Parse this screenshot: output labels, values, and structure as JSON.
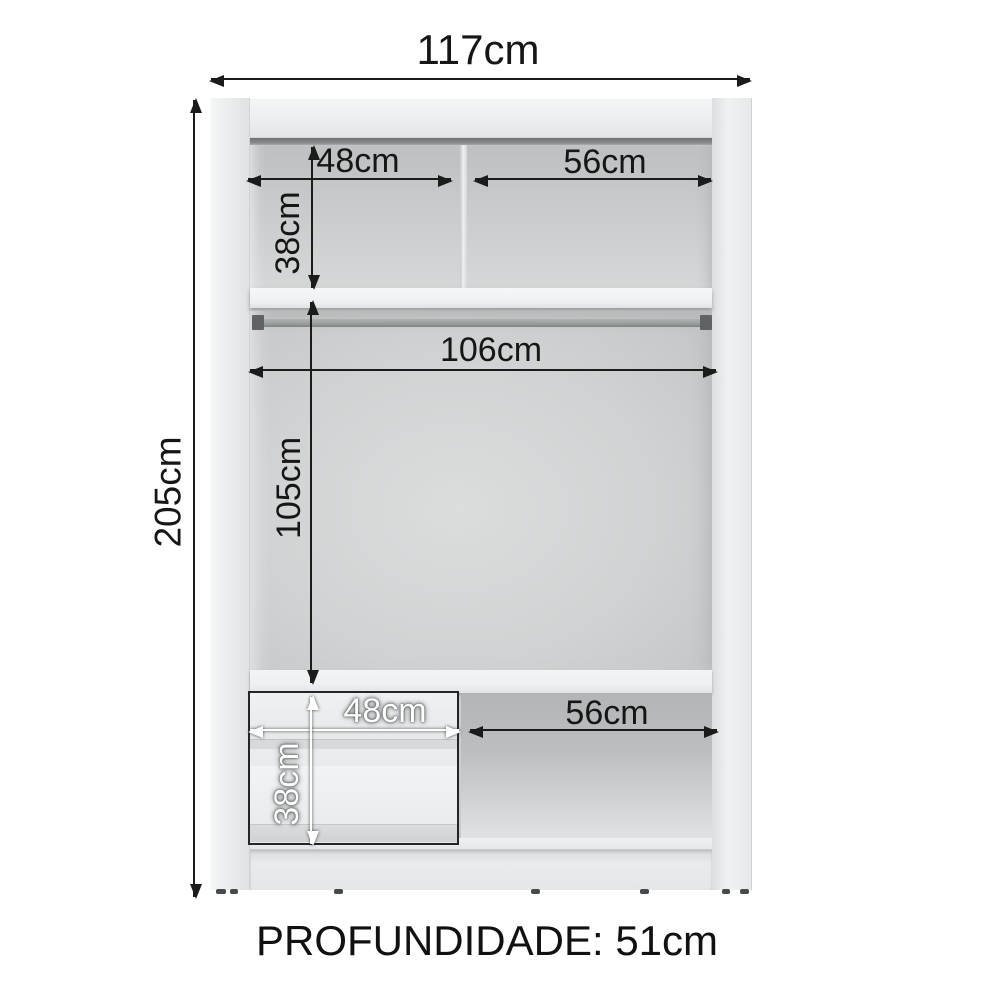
{
  "diagram": {
    "kind": "wardrobe-internal-dimensions",
    "depth_note": "PROFUNDIDADE: 51cm",
    "dimensions": {
      "overall_width": "117cm",
      "overall_height": "205cm",
      "upper_left_width": "48cm",
      "upper_right_width": "56cm",
      "upper_height": "38cm",
      "rod_width": "106cm",
      "hanging_height": "105cm",
      "lower_left_width": "48cm",
      "lower_right_width": "56cm",
      "lower_height": "38cm"
    },
    "colors": {
      "dimension_ink": "#1b1b1b",
      "light_dimension_ink": "#ffffff",
      "cabinet_panel": "#edeff0",
      "interior_back": "#cdcfd0",
      "ceiling_shadow": "#6f7374",
      "rod": "#9aa09f",
      "drawer_gap": "#4e5253",
      "background": "#ffffff"
    }
  }
}
